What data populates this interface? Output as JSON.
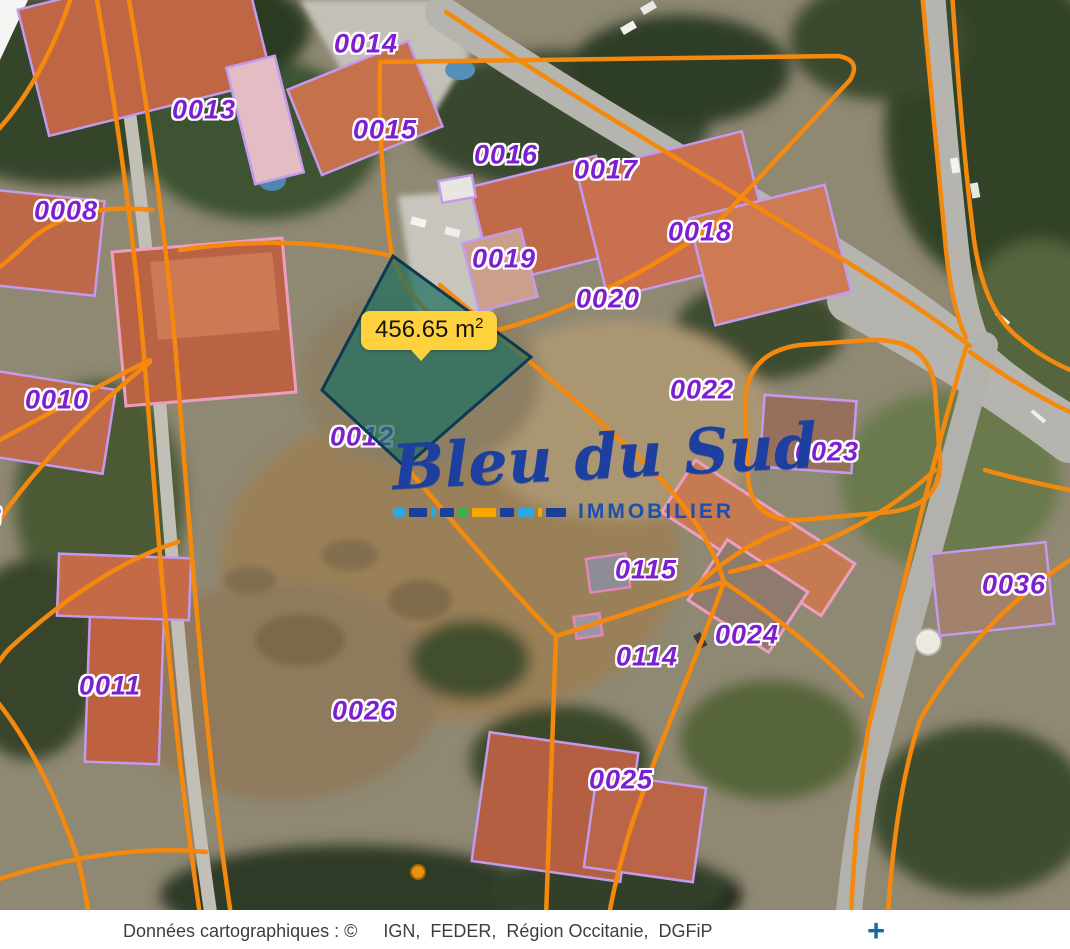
{
  "map": {
    "selected_parcel": {
      "parcel_id": "0012",
      "area_text": "456.65 m",
      "area_sup": "2"
    },
    "parcels": [
      {
        "id": "0014",
        "x": 366,
        "y": 44
      },
      {
        "id": "0013",
        "x": 204,
        "y": 110
      },
      {
        "id": "0015",
        "x": 385,
        "y": 130
      },
      {
        "id": "0016",
        "x": 506,
        "y": 155
      },
      {
        "id": "0017",
        "x": 606,
        "y": 170
      },
      {
        "id": "0008",
        "x": 66,
        "y": 211
      },
      {
        "id": "0018",
        "x": 700,
        "y": 232
      },
      {
        "id": "0019",
        "x": 504,
        "y": 259
      },
      {
        "id": "0020",
        "x": 608,
        "y": 299
      },
      {
        "id": "0010",
        "x": 57,
        "y": 400
      },
      {
        "id": "0022",
        "x": 702,
        "y": 390
      },
      {
        "id": "0012",
        "x": 362,
        "y": 437
      },
      {
        "id": "0023",
        "x": 827,
        "y": 452
      },
      {
        "id": "3",
        "x": -6,
        "y": 517
      },
      {
        "id": "0115",
        "x": 646,
        "y": 570
      },
      {
        "id": "0036",
        "x": 1014,
        "y": 585
      },
      {
        "id": "0024",
        "x": 747,
        "y": 635
      },
      {
        "id": "0114",
        "x": 647,
        "y": 657
      },
      {
        "id": "0011",
        "x": 110,
        "y": 686
      },
      {
        "id": "0026",
        "x": 364,
        "y": 711
      },
      {
        "id": "0025",
        "x": 621,
        "y": 780
      }
    ],
    "colors": {
      "boundary_orange": "#f5890d",
      "building_purple": "#c49aee",
      "building_pink": "#ec9ec0",
      "label_purple": "#7d1fd1",
      "selected_fill": "#1e6f5f",
      "selected_border": "#0d3a52",
      "tooltip_yellow": "#ffd23d"
    }
  },
  "watermark": {
    "title": "Bleu du Sud",
    "subtitle": "IMMOBILIER",
    "dashes": [
      {
        "c": "#2fa8e0",
        "w": 12
      },
      {
        "c": "#1b3f97",
        "w": 18
      },
      {
        "c": "#2fa8e0",
        "w": 5
      },
      {
        "c": "#1b3f97",
        "w": 14
      },
      {
        "c": "#3cae4b",
        "w": 10
      },
      {
        "c": "#f6a800",
        "w": 24
      },
      {
        "c": "#1b3f97",
        "w": 14
      },
      {
        "c": "#2fa8e0",
        "w": 16
      },
      {
        "c": "#f6a800",
        "w": 4
      },
      {
        "c": "#1b3f97",
        "w": 20
      }
    ]
  },
  "attribution": {
    "prefix": "Données cartographiques : ©",
    "sources": "IGN,  FEDER,  Région Occitanie,  DGFiP"
  },
  "controls": {
    "zoom_in": "+"
  }
}
